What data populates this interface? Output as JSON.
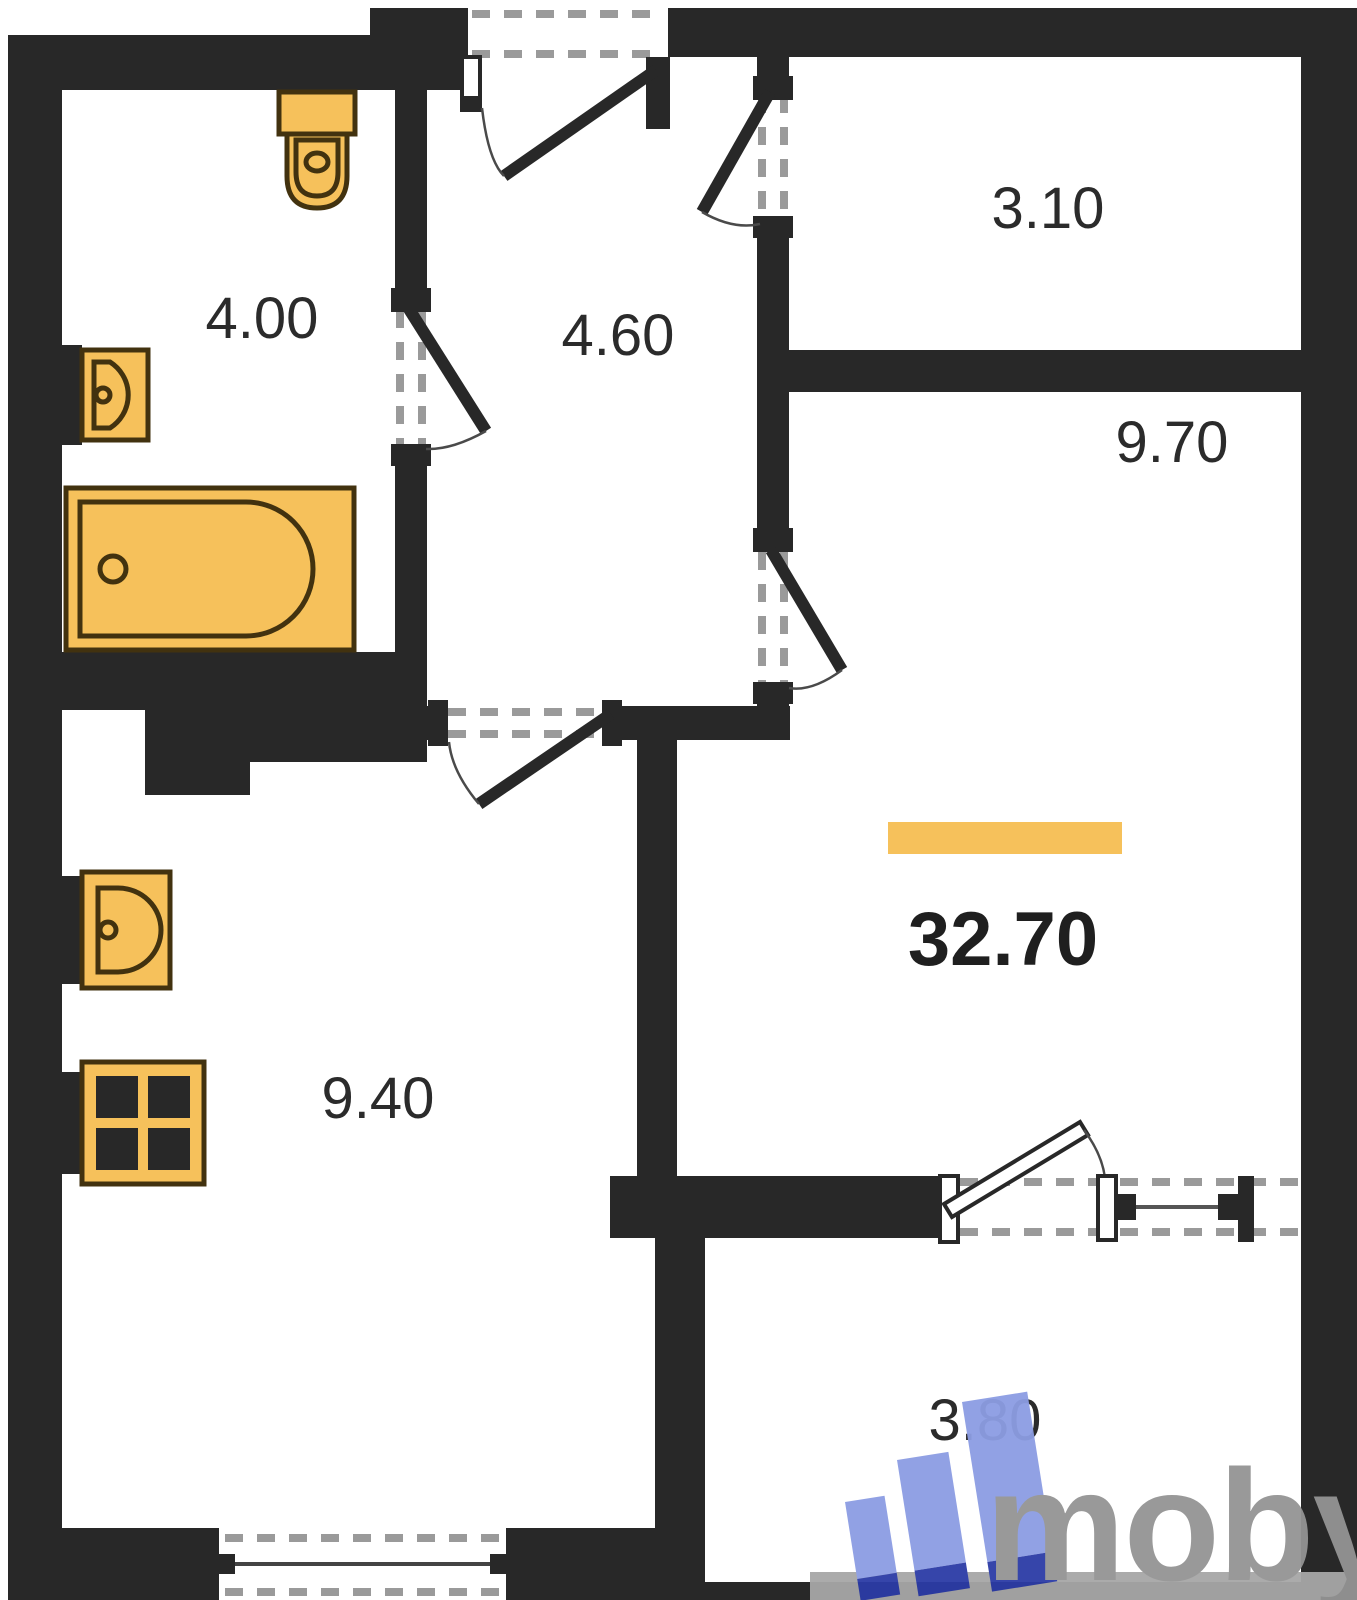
{
  "title": "Apartment floor plan",
  "rooms": {
    "bathroom": {
      "area": "4.00"
    },
    "hallway": {
      "area": "4.60"
    },
    "storage": {
      "area": "3.10"
    },
    "living": {
      "area": "9.70"
    },
    "kitchen": {
      "area": "9.40"
    },
    "balcony": {
      "area": "3.80"
    }
  },
  "total_area": "32.70",
  "logo": {
    "text": "moby"
  },
  "colors": {
    "wall": "#282828",
    "fixture_fill": "#F6C15B",
    "fixture_outline": "#42320f",
    "highlight_bar": "#F6C15B",
    "label_text": "#2b2b2b",
    "dash": "#9a9a9a",
    "logo_blue": "#8C9DE3",
    "logo_blue_dark": "#2C3CA6",
    "logo_gray": "#949494"
  }
}
